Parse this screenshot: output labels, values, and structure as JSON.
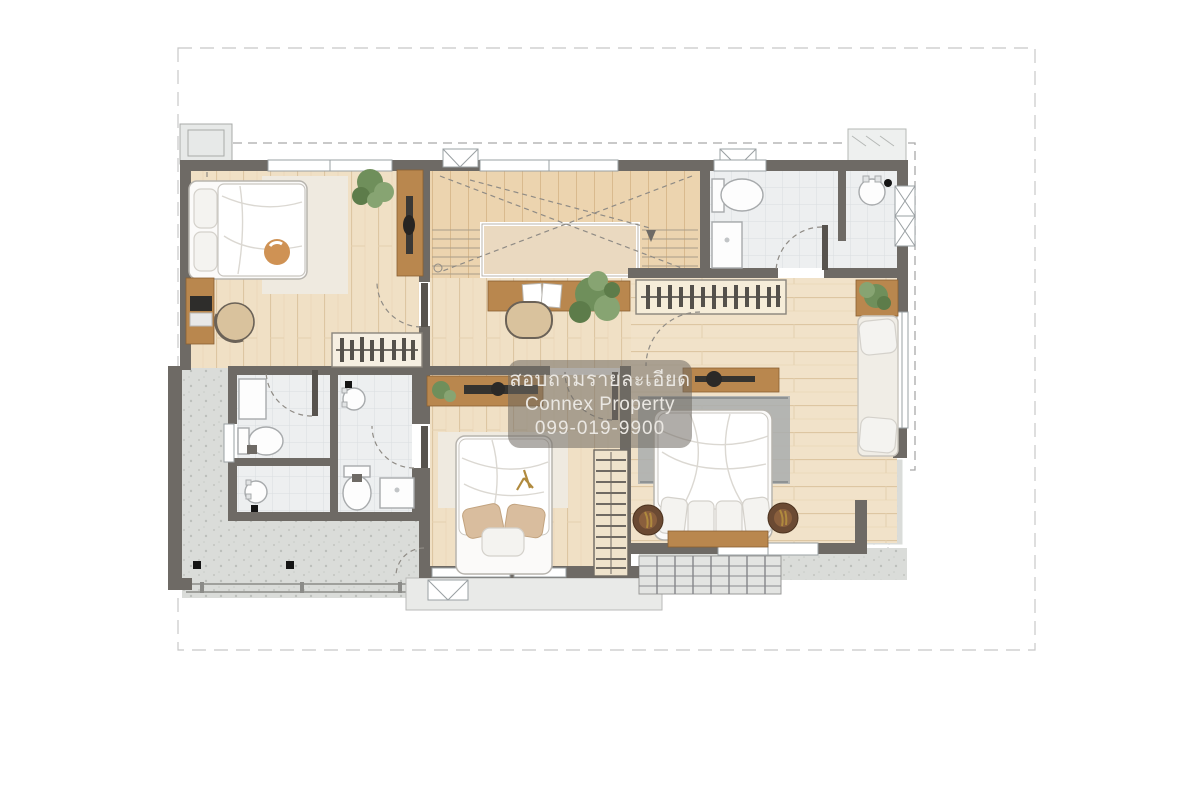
{
  "watermark": {
    "thai_line": "สอบถามรายละเอียด",
    "brand_line": "Connex Property",
    "phone_line": "099-019-9900"
  },
  "colors": {
    "wall": "#6e6a65",
    "wood_floor": "#f0e0c5",
    "wood_floor_line": "#ddc6a2",
    "stair_wood": "#ecd4af",
    "tile": "#edeff0",
    "tile_line": "#d9dde0",
    "concrete": "#dadcd9",
    "furniture_wood": "#b9874e",
    "rug_cream": "#efeae0",
    "rug_gray": "#a9adae",
    "bedding": "#ffffff",
    "plant_green": "#6f8f5b",
    "accent_gold": "#b08a3e",
    "boundary_line": "#c8c8c8",
    "roof_dash": "#a9a9a9",
    "watermark_bg": "rgba(112,106,99,0.55)",
    "watermark_text": "#eae7e2"
  }
}
